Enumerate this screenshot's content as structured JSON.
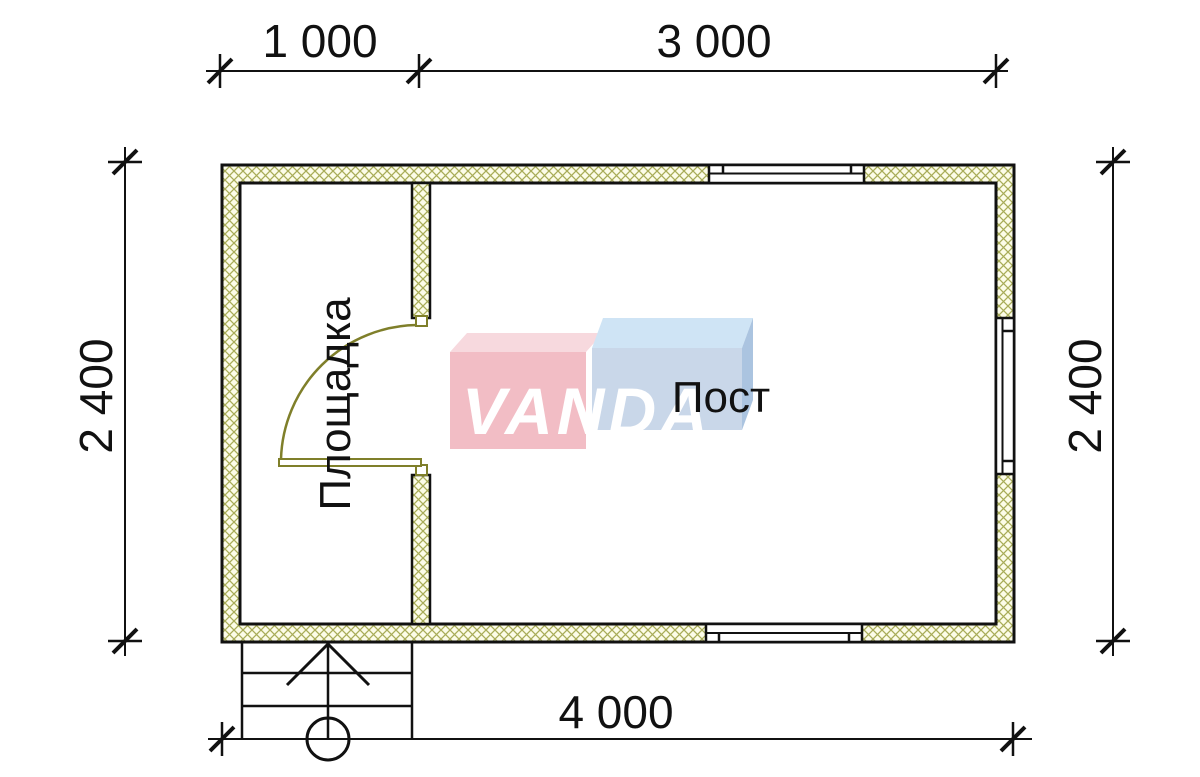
{
  "drawing": {
    "type": "floor-plan",
    "dimensions": {
      "top_left": "1 000",
      "top_right": "3 000",
      "left": "2 400",
      "right": "2 400",
      "bottom": "4 000"
    },
    "rooms": {
      "left_room": "Площадка",
      "right_room": "Пост"
    },
    "watermark": {
      "text": "VANDA"
    },
    "colors": {
      "line": "#111111",
      "hatch_stroke": "#a8ac58",
      "hatch_bg": "#fcfce8",
      "door": "#7f7f2a",
      "logo_red_front": "#f2bdc5",
      "logo_red_top": "#f7d9de",
      "logo_blue_front": "#c9d7e9",
      "logo_blue_top": "#cfe4f5",
      "logo_blue_side": "#abc4e0"
    }
  }
}
